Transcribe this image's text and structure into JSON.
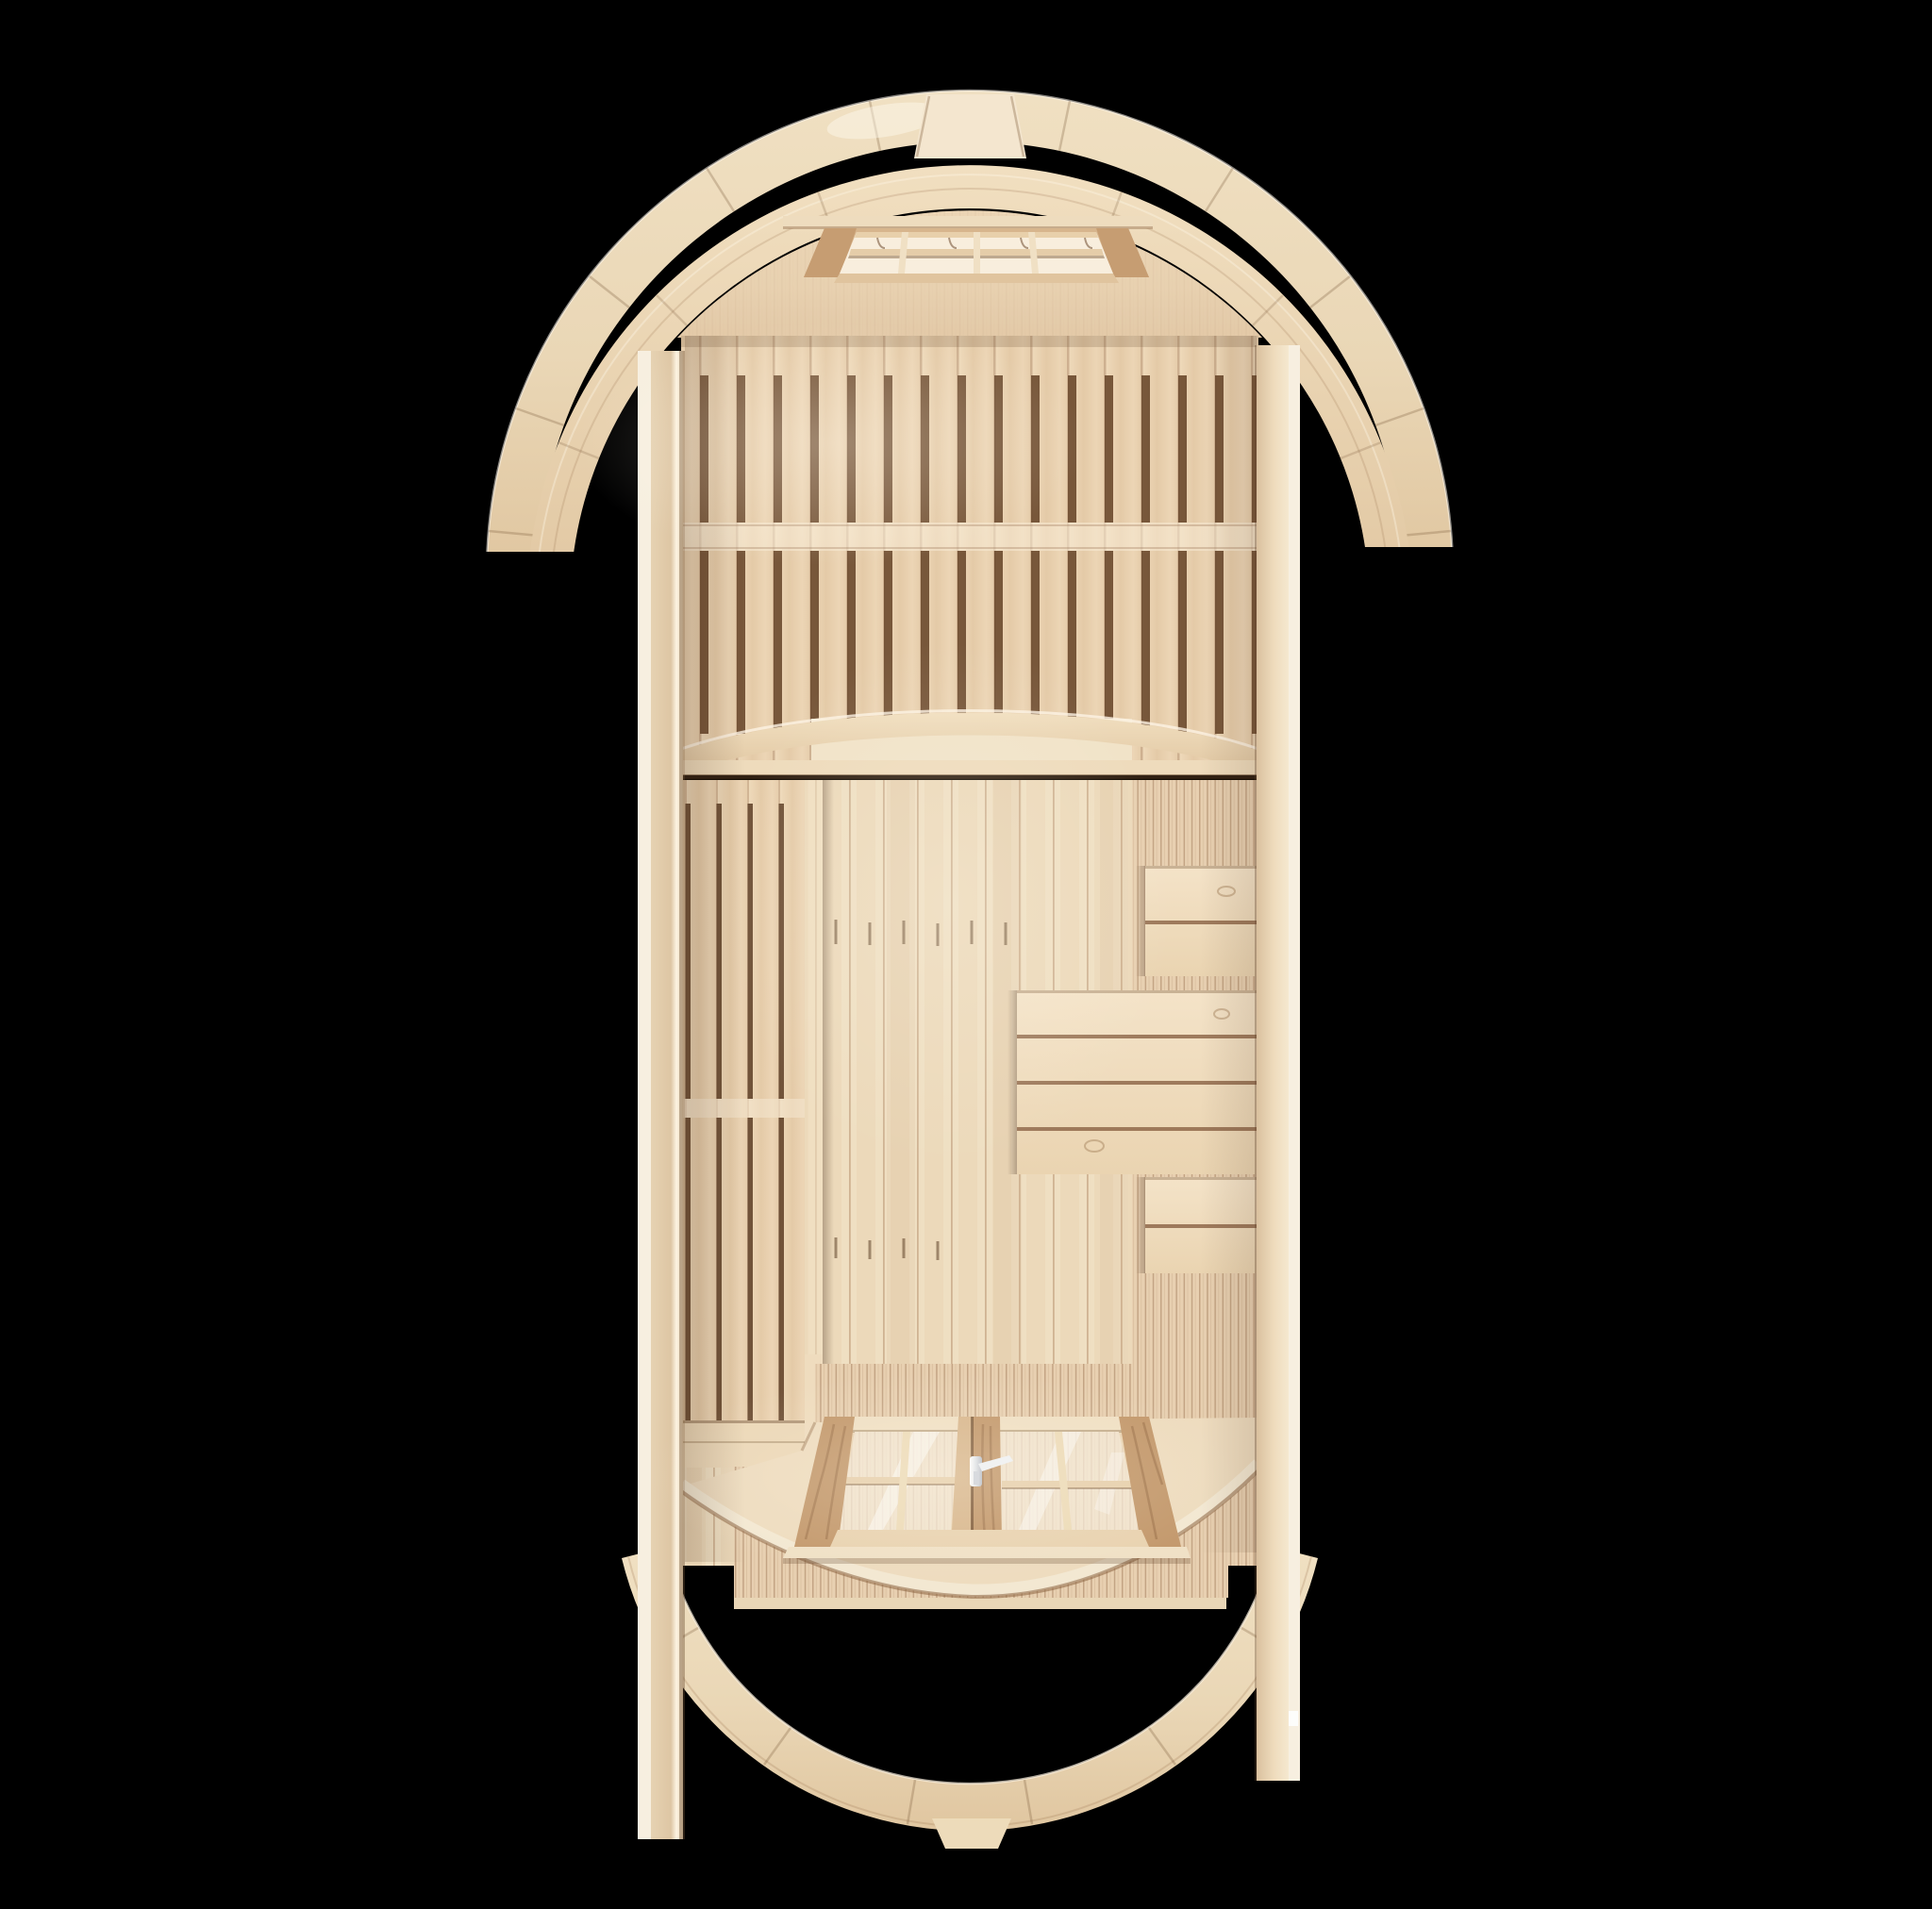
{
  "scene": {
    "subject": "barrel sauna interior, top-down cutaway 3d render",
    "rooms": [
      "sauna room (rear)",
      "changing room (front)",
      "open porch"
    ],
    "background": "#000000"
  },
  "palette": {
    "background": "#000000",
    "wood_highlight": "#f8f0e0",
    "wood_bright": "#f3e5ca",
    "wood_light": "#eedbbc",
    "wood_mid": "#e7cfae",
    "wood_deep": "#dabf9b",
    "seam": "#c8a886",
    "gap_dark": "#6e4c30",
    "shadow_brown": "#8a6748",
    "glass": "#f5ead8",
    "glass_warm": "#f8eedd",
    "metal": "#eef0f3",
    "door_stile_dark": "#c49a6e",
    "door_stile_light": "#d9b88f",
    "door_frame": "#ead4b3",
    "bench_wood": "#f1dec1",
    "platform": "#eedcbf",
    "front_band": "#e7cfb0",
    "fine_band": "#e9d1b2",
    "under_arch": "#f1e3c8",
    "wall_edge_white": "#f7efe0"
  },
  "parts": {
    "rear_ring": "rear barrel end arch ring",
    "cap_block": "apex cap block",
    "roof_arch": "roof arch band",
    "rear_wall": "rear wall top panel",
    "skylight": "roof vent window with slats",
    "sauna_slats": "slatted sauna benches (top view)",
    "divider": "arched room partition",
    "left_bench": "left slatted bench",
    "floor": "floor boards",
    "side_wall_band": "curved side wall boards",
    "bench_small_top": "small bench / stool",
    "bench_large": "large bench / table",
    "bench_small_bottom": "small bench / stool",
    "door": "glass double door (top view)",
    "door_handle": "metal door handle",
    "platform": "entrance platform",
    "front_wall": "front wall boards",
    "front_ring": "front barrel end arch ring",
    "left_wall": "left side wall edge",
    "right_wall": "right side wall edge"
  }
}
